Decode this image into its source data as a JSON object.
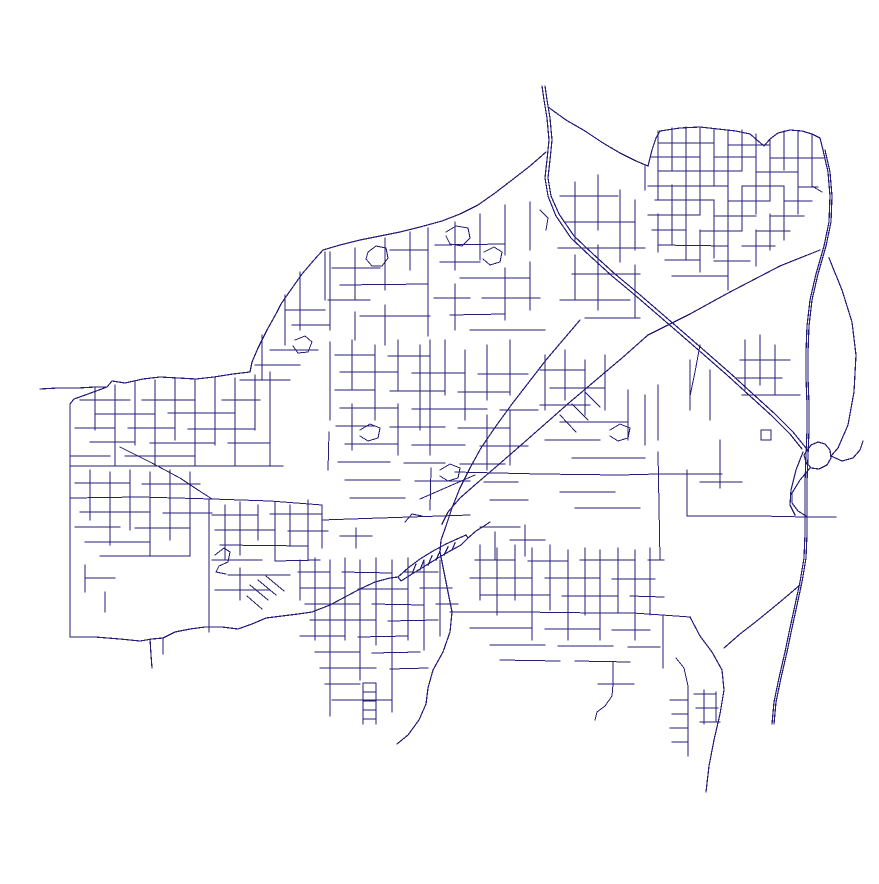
{
  "map": {
    "kind": "street-network-map",
    "background": "#ffffff",
    "road_color": "#251c78",
    "major_stroke_width": 1.2,
    "street_stroke_width": 1,
    "width": 879,
    "height": 884,
    "layers": {
      "major_roads": [
        "542,86 544,100 547,118 549,140 547,160 545,178 548,196 556,216 571,238 590,256 612,276 636,296 658,315 680,334 703,354 727,375 750,396 772,416 790,434 802,449",
        "545,86 547,100 550,118 552,140 550,160 548,178 551,196 559,214 574,236 593,254 615,274 639,294 661,313 683,332 706,352 730,373 753,394 775,414 793,432 806,448",
        "546,152 530,166 512,180 495,193 478,205 460,214 442,221 420,227 400,232 380,236 360,240 340,245 323,250",
        "323,250 314,260 302,274 290,291 281,304 277,312 267,330 258,348 252,362 250,372",
        "250,372 233,374 214,377 196,379 178,378 160,377 143,379 125,383 112,381 107,387 95,387 78,388 58,388 40,389",
        "107,387 88,394 74,399 70,404",
        "70,404 70,440 70,480 70,520 70,560 70,600 70,637",
        "70,637 95,637 120,639 140,641 152,639 163,638",
        "163,638 175,632 190,629 205,627 222,627 238,629 252,624 266,618 282,616 298,614 312,612 330,605 345,597 360,589 375,582 390,578 398,577",
        "150,639 151,655 152,668",
        "163,638 163,654",
        "398,577 408,568 420,559 433,551 446,544 457,539 466,535",
        "401,581 412,574 425,566 438,558 450,551 461,545 468,538",
        "398,577 401,581",
        "466,535 468,538",
        "412,574 416,564",
        "420,570 424,560",
        "428,565 432,556",
        "436,560 440,551",
        "444,555 448,547",
        "452,550 455,543",
        "468,538 476,531 484,526 490,522",
        "820,250 780,266 730,292 690,314 648,335",
        "648,335 622,358 596,380 570,402 545,424 520,446 497,466 476,484 460,498 448,512 442,524",
        "580,320 563,340 546,360 529,382 512,404 496,426 481,448 470,468 460,488 452,508 446,526 441,540 440,552 444,572 448,592 452,612 450,632 443,652 433,670 428,688 426,704 419,720 408,735 397,744",
        "823,150 828,172 830,196 829,222 824,246 816,274 810,300 807,326 806,352 806,378 807,404 807,430 806,456 805,482 805,508 805,534 804,558 800,582 795,605 790,628 785,652 779,678 774,702 772,724",
        "825,150 830,172 832,196 831,222 826,246 818,274 812,300 809,326 808,352 808,378 809,404 809,430 808,456 807,482 807,508 807,534 806,558 802,582 797,605 792,628 787,652 781,678 776,702 774,724",
        "806,452 811,445 818,442 825,444 830,450 831,458 827,465 819,469 811,468 806,462 804,455 806,452",
        "810,468 800,480 792,493 792,503 798,511 806,516",
        "803,452 796,470 791,490 790,505 795,515",
        "829,258 842,290 852,322 856,355 854,392 848,425 838,448 831,456",
        "831,456 842,461 853,458 860,450 863,441",
        "548,107 566,120 585,131 603,143 620,153 636,161 648,166",
        "648,166 652,150 656,138 660,131",
        "660,131 680,128 700,127 718,129 736,131 750,134 757,140 764,146 770,139 778,133 790,130 802,131 812,134 820,138 823,150",
        "800,585 780,602 758,620 740,634 724,648",
        "690,617 700,636 712,652 722,670 724,690 720,714 714,740 709,766 706,792"
      ],
      "streets": [
        "658,131 658,200",
        "658,214 658,252",
        "672,128 672,170",
        "672,185 672,244",
        "686,127 686,260",
        "700,127 700,214",
        "700,230 700,272",
        "714,129 714,185",
        "714,200 714,258",
        "728,131 728,290",
        "742,130 742,170",
        "742,186 742,230",
        "756,134 756,214",
        "756,230 756,266",
        "770,139 770,200",
        "770,214 770,250",
        "784,131 784,170",
        "784,186 784,240",
        "798,131 798,214",
        "812,134 812,186",
        "812,158 824,158",
        "812,186 822,192",
        "645,166 645,190",
        "658,143 714,143",
        "728,145 770,145",
        "650,157 700,157",
        "714,157 756,157",
        "770,158 812,158",
        "658,171 742,171",
        "756,172 798,172",
        "648,186 728,186",
        "742,186 784,186",
        "798,187 818,187",
        "655,200 714,200",
        "728,201 770,201",
        "784,201 812,201",
        "648,215 700,215",
        "714,216 756,216",
        "770,216 804,216",
        "652,230 686,230",
        "700,231 742,231",
        "756,231 790,231",
        "658,245 728,246",
        "742,246 775,246",
        "665,260 700,260",
        "714,261 750,261",
        "672,276 728,276",
        "575,182 575,240",
        "575,255 575,300",
        "598,175 598,230",
        "598,245 598,310",
        "620,190 620,262",
        "635,200 635,250",
        "635,265 635,318",
        "560,196 618,196",
        "565,222 635,222",
        "558,248 645,248",
        "572,274 640,274",
        "560,300 630,300",
        "585,318 640,318",
        "355,248 355,300",
        "355,312 355,340",
        "385,238 385,290",
        "385,305 385,345",
        "410,232 410,270",
        "428,228 428,336",
        "455,222 455,270",
        "455,284 455,330",
        "480,214 480,260",
        "505,205 505,255",
        "505,268 505,320",
        "530,202 530,250",
        "530,262 530,310",
        "332,268 380,268",
        "340,285 428,284",
        "328,300 370,300",
        "360,316 430,316",
        "390,250 428,250",
        "435,245 505,244",
        "440,262 480,262",
        "460,278 530,278",
        "434,298 470,298",
        "482,298 540,298",
        "450,315 505,314",
        "470,330 545,330",
        "368,252 376,246 386,248 388,258 382,266 372,266 366,259 368,252",
        "446,232 456,226 468,228 470,238 462,246 450,244 446,236",
        "484,252 494,247 502,252 500,262 490,265 483,259",
        "540,210 548,218 546,230",
        "325,252 325,300",
        "300,272 300,330",
        "285,295 285,345",
        "262,335 262,380",
        "270,350 318,350",
        "255,365 300,365",
        "240,380 290,380",
        "285,310 325,310",
        "292,325 330,325",
        "295,340 305,336 312,342 308,352 298,353 293,346",
        "235,378 235,430",
        "222,400 260,400",
        "330,252 330,330",
        "330,342 330,420",
        "329,432 328,470",
        "95,388 95,430",
        "115,385 115,465",
        "135,382 135,445",
        "155,380 155,465",
        "175,379 175,440",
        "195,380 195,466",
        "215,378 215,445",
        "235,380 235,466",
        "255,375 255,430",
        "270,372 270,466",
        "80,400 130,400",
        "142,400 195,400",
        "95,414 155,414",
        "168,413 235,413",
        "75,428 115,428",
        "128,428 175,428",
        "188,429 255,429",
        "90,442 135,442",
        "150,443 215,443",
        "228,443 270,443",
        "70,456 110,456",
        "125,456 195,456",
        "120,447 150,462 180,478 198,490 212,499",
        "70,466 160,466 283,466",
        "70,498 140,497 212,499 270,501 322,505",
        "90,470 90,520",
        "110,472 110,545",
        "130,470 130,530",
        "150,472 150,556",
        "170,470 170,540",
        "190,472 190,556",
        "75,483 130,483",
        "142,484 200,484",
        "80,512 150,512",
        "163,513 212,513",
        "75,527 120,527",
        "135,528 190,528",
        "85,542 150,542",
        "100,556 190,556",
        "85,565 85,592",
        "85,578 115,578",
        "105,592 105,612",
        "209,500 209,632",
        "225,505 225,560",
        "240,502 240,555",
        "240,568 240,600",
        "258,505 258,540",
        "275,502 275,560",
        "290,505 290,545",
        "308,500 308,560",
        "322,505 322,548",
        "212,515 258,515",
        "270,514 322,514",
        "215,530 275,530",
        "288,531 328,531",
        "220,545 308,546",
        "212,560 262,560",
        "275,561 320,560",
        "228,575 290,575",
        "215,590 270,590",
        "215,555 224,548 230,552 228,562 219,566 216,572 226,574",
        "250,585 268,600",
        "258,580 276,595",
        "266,576 284,591",
        "247,596 262,609",
        "352,340 352,390",
        "352,404 352,450",
        "375,345 375,420",
        "398,340 398,390",
        "398,404 398,455",
        "420,345 420,430",
        "430,340 430,380",
        "430,380 430,455",
        "431,468 430,510",
        "445,340 445,395",
        "465,350 465,420",
        "487,345 487,400",
        "487,415 487,470",
        "510,340 510,395",
        "510,410 510,465",
        "335,355 375,355",
        "388,356 430,356",
        "340,372 398,372",
        "412,373 465,373",
        "478,374 528,374",
        "335,390 375,390",
        "390,391 445,391",
        "458,392 510,392",
        "340,408 398,408",
        "412,409 487,409",
        "500,410 538,410",
        "336,426 375,426",
        "390,427 445,427",
        "458,428 510,428",
        "345,444 398,444",
        "412,445 465,445",
        "480,446 528,446",
        "338,462 390,462",
        "404,463 445,463",
        "460,464 505,464",
        "345,480 400,480",
        "415,481 470,481",
        "484,482 518,482",
        "350,498 405,498",
        "420,499 475,475",
        "490,500 528,500",
        "360,430 370,424 380,428 378,438 368,441 360,436",
        "440,470 450,464 460,468 458,478 448,481 440,476",
        "405,522 412,514 422,516",
        "322,520 380,518 440,516 470,515",
        "545,355 545,410",
        "565,350 565,400",
        "585,360 585,415",
        "605,355 605,410",
        "628,390 628,440",
        "645,395 645,445",
        "540,370 585,370",
        "550,388 605,388",
        "540,405 590,405",
        "560,422 628,422",
        "545,440 600,440",
        "572,458 645,458",
        "560,492 615,492",
        "575,508 640,508",
        "560,415 576,432",
        "572,404 588,420",
        "585,392 600,407",
        "610,430 620,424 630,428 628,438 618,441 610,436",
        "658,385 658,440",
        "658,452 660,560",
        "455,472 540,474 620,475 658,474 722,474",
        "745,340 745,390",
        "760,335 760,385",
        "775,345 775,395",
        "740,360 790,360",
        "735,378 782,378",
        "742,395 800,395",
        "761,430 771,430 771,440 761,440 761,430",
        "690,360 690,410",
        "710,370 710,420",
        "700,345 695,372 690,396",
        "687,470 687,516",
        "720,440 720,488",
        "700,482 742,482",
        "687,516 760,516 806,517 836,517",
        "480,527 520,527",
        "495,532 495,560",
        "510,540 545,540",
        "525,525 525,556",
        "356,528 356,548",
        "340,536 372,536",
        "480,545 480,600",
        "497,548 497,615",
        "515,545 515,600",
        "532,548 532,640",
        "550,545 550,610",
        "568,550 568,640",
        "585,548 585,615",
        "600,550 600,640",
        "618,548 618,612",
        "635,550 635,640",
        "650,548 650,615",
        "475,560 515,560",
        "528,561 568,561",
        "580,560 635,560",
        "648,560 664,560",
        "470,578 532,578",
        "545,578 600,578",
        "612,579 655,579",
        "480,595 550,595",
        "562,596 618,596",
        "630,596 664,597",
        "470,628 532,628",
        "545,629 600,629",
        "612,630 650,630",
        "490,645 545,645",
        "558,646 613,646",
        "628,647 660,647",
        "500,660 560,661",
        "575,661 630,662",
        "450,612 520,612 600,613 633,613",
        "633,613 662,615 690,617",
        "613,662 613,684",
        "598,684 634,684",
        "613,684 612,696 605,706 597,712 595,720",
        "663,615 663,668",
        "688,686 688,756",
        "670,700 688,700",
        "672,714 688,714",
        "670,728 688,728",
        "672,742 688,742",
        "688,686 684,668 676,658",
        "694,694 716,694",
        "696,708 718,708",
        "700,722 720,722",
        "704,690 704,724",
        "716,692 716,722",
        "300,560 300,600",
        "315,558 315,640",
        "330,560 330,700",
        "345,558 345,640",
        "360,560 360,680",
        "376,558 376,645",
        "392,560 392,700",
        "408,558 408,640",
        "424,560 424,650",
        "440,560 440,636",
        "298,572 330,572",
        "342,572 392,573",
        "404,572 438,572",
        "300,588 345,588",
        "358,589 408,589",
        "420,588 452,588",
        "305,604 360,604",
        "372,604 424,605",
        "436,604 458,604",
        "310,620 376,620",
        "388,621 438,620",
        "300,636 345,636",
        "358,637 408,636",
        "315,652 360,652",
        "372,653 420,652",
        "320,668 376,668",
        "390,669 428,668",
        "325,684 360,684",
        "332,700 392,700",
        "363,683 376,683",
        "363,692 376,692",
        "363,701 376,701",
        "363,710 376,710",
        "363,719 376,719",
        "363,683 363,724",
        "376,683 376,724",
        "330,700 330,716",
        "392,700 392,712"
      ]
    }
  }
}
